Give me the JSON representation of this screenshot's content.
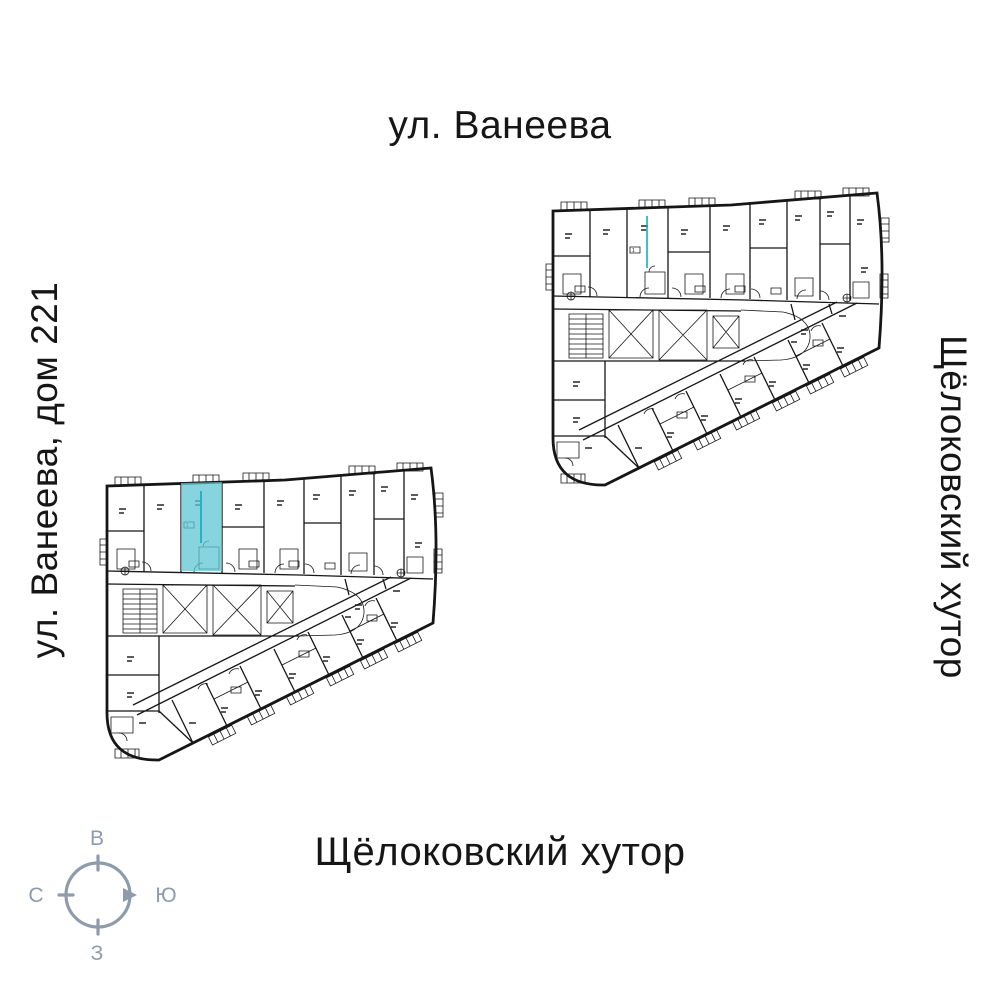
{
  "labels": {
    "street_top": "ул. Ванеева",
    "street_left": "ул. Ванеева, дом 221",
    "district_right": "Щёлоковский хутор",
    "district_bottom": "Щёлоковский хутор"
  },
  "compass": {
    "top": "В",
    "right": "Ю",
    "bottom": "З",
    "left": "С"
  },
  "plans": {
    "left": {
      "highlighted_unit_badge": "1"
    }
  },
  "colors": {
    "wall": "#161616",
    "highlight": "#5fc4d3",
    "accent": "#12aec4",
    "compass": "#8e9bab",
    "text": "#161616",
    "bg": "#ffffff"
  }
}
